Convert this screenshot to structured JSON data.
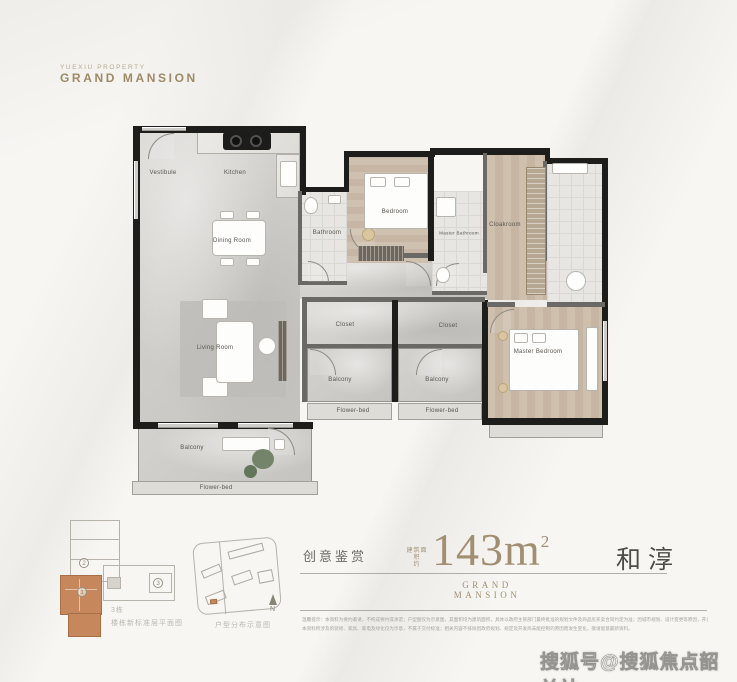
{
  "brand": {
    "tagline": "YUEXIU PROPERTY",
    "name": "GRAND MANSION"
  },
  "floorplan": {
    "vestibule": "Vestibule",
    "kitchen": "Kitchen",
    "dining_room": "Dining Room",
    "living_room": "Living Room",
    "bathroom": "Bathroom",
    "bedroom": "Bedroom",
    "master_bathroom": "Master Bathroom",
    "cloakroom": "Cloakroom",
    "master_bedroom": "Master Bedroom",
    "closet": "Closet",
    "balcony": "Balcony",
    "flower_bed": "Flower-bed"
  },
  "keyplan": {
    "building": "3栋",
    "caption": "楼栋新标准层平面图",
    "unit_1": "1",
    "unit_2": "2",
    "unit_3": "3"
  },
  "siteplan": {
    "caption": "户型分布示意图",
    "north": "N"
  },
  "info": {
    "category": "创意鉴赏",
    "area_prefix_top": "建筑面积",
    "area_prefix_bottom": "约",
    "area_value": "143m",
    "area_sup": "2",
    "series": "GRAND MANSION",
    "product": "和淳"
  },
  "disclaimer": {
    "line1": "温馨提示：本资料为要约邀请，不构成要约或承诺；户型图仅为示意图，其面积均为建筑面积，具体以政府主管部门最终批准的规划文件及商品房买卖合同约定为准；因城市规划、设计变更等原因，开发商保留修改的权利。",
    "line2": "本资料所涉及的装修、家具、家电及绿化仅为示意，不属于交付标准；相关内容不排除因政府规划、规定及开发商未能控制的原因而发生变化，敬请留意最新资料。"
  },
  "watermark": "搜狐号@搜狐焦点韶关站",
  "colors": {
    "accent_gold": "#a28f72",
    "unit_highlight": "#c6875c",
    "wall": "#1d1d1b"
  }
}
